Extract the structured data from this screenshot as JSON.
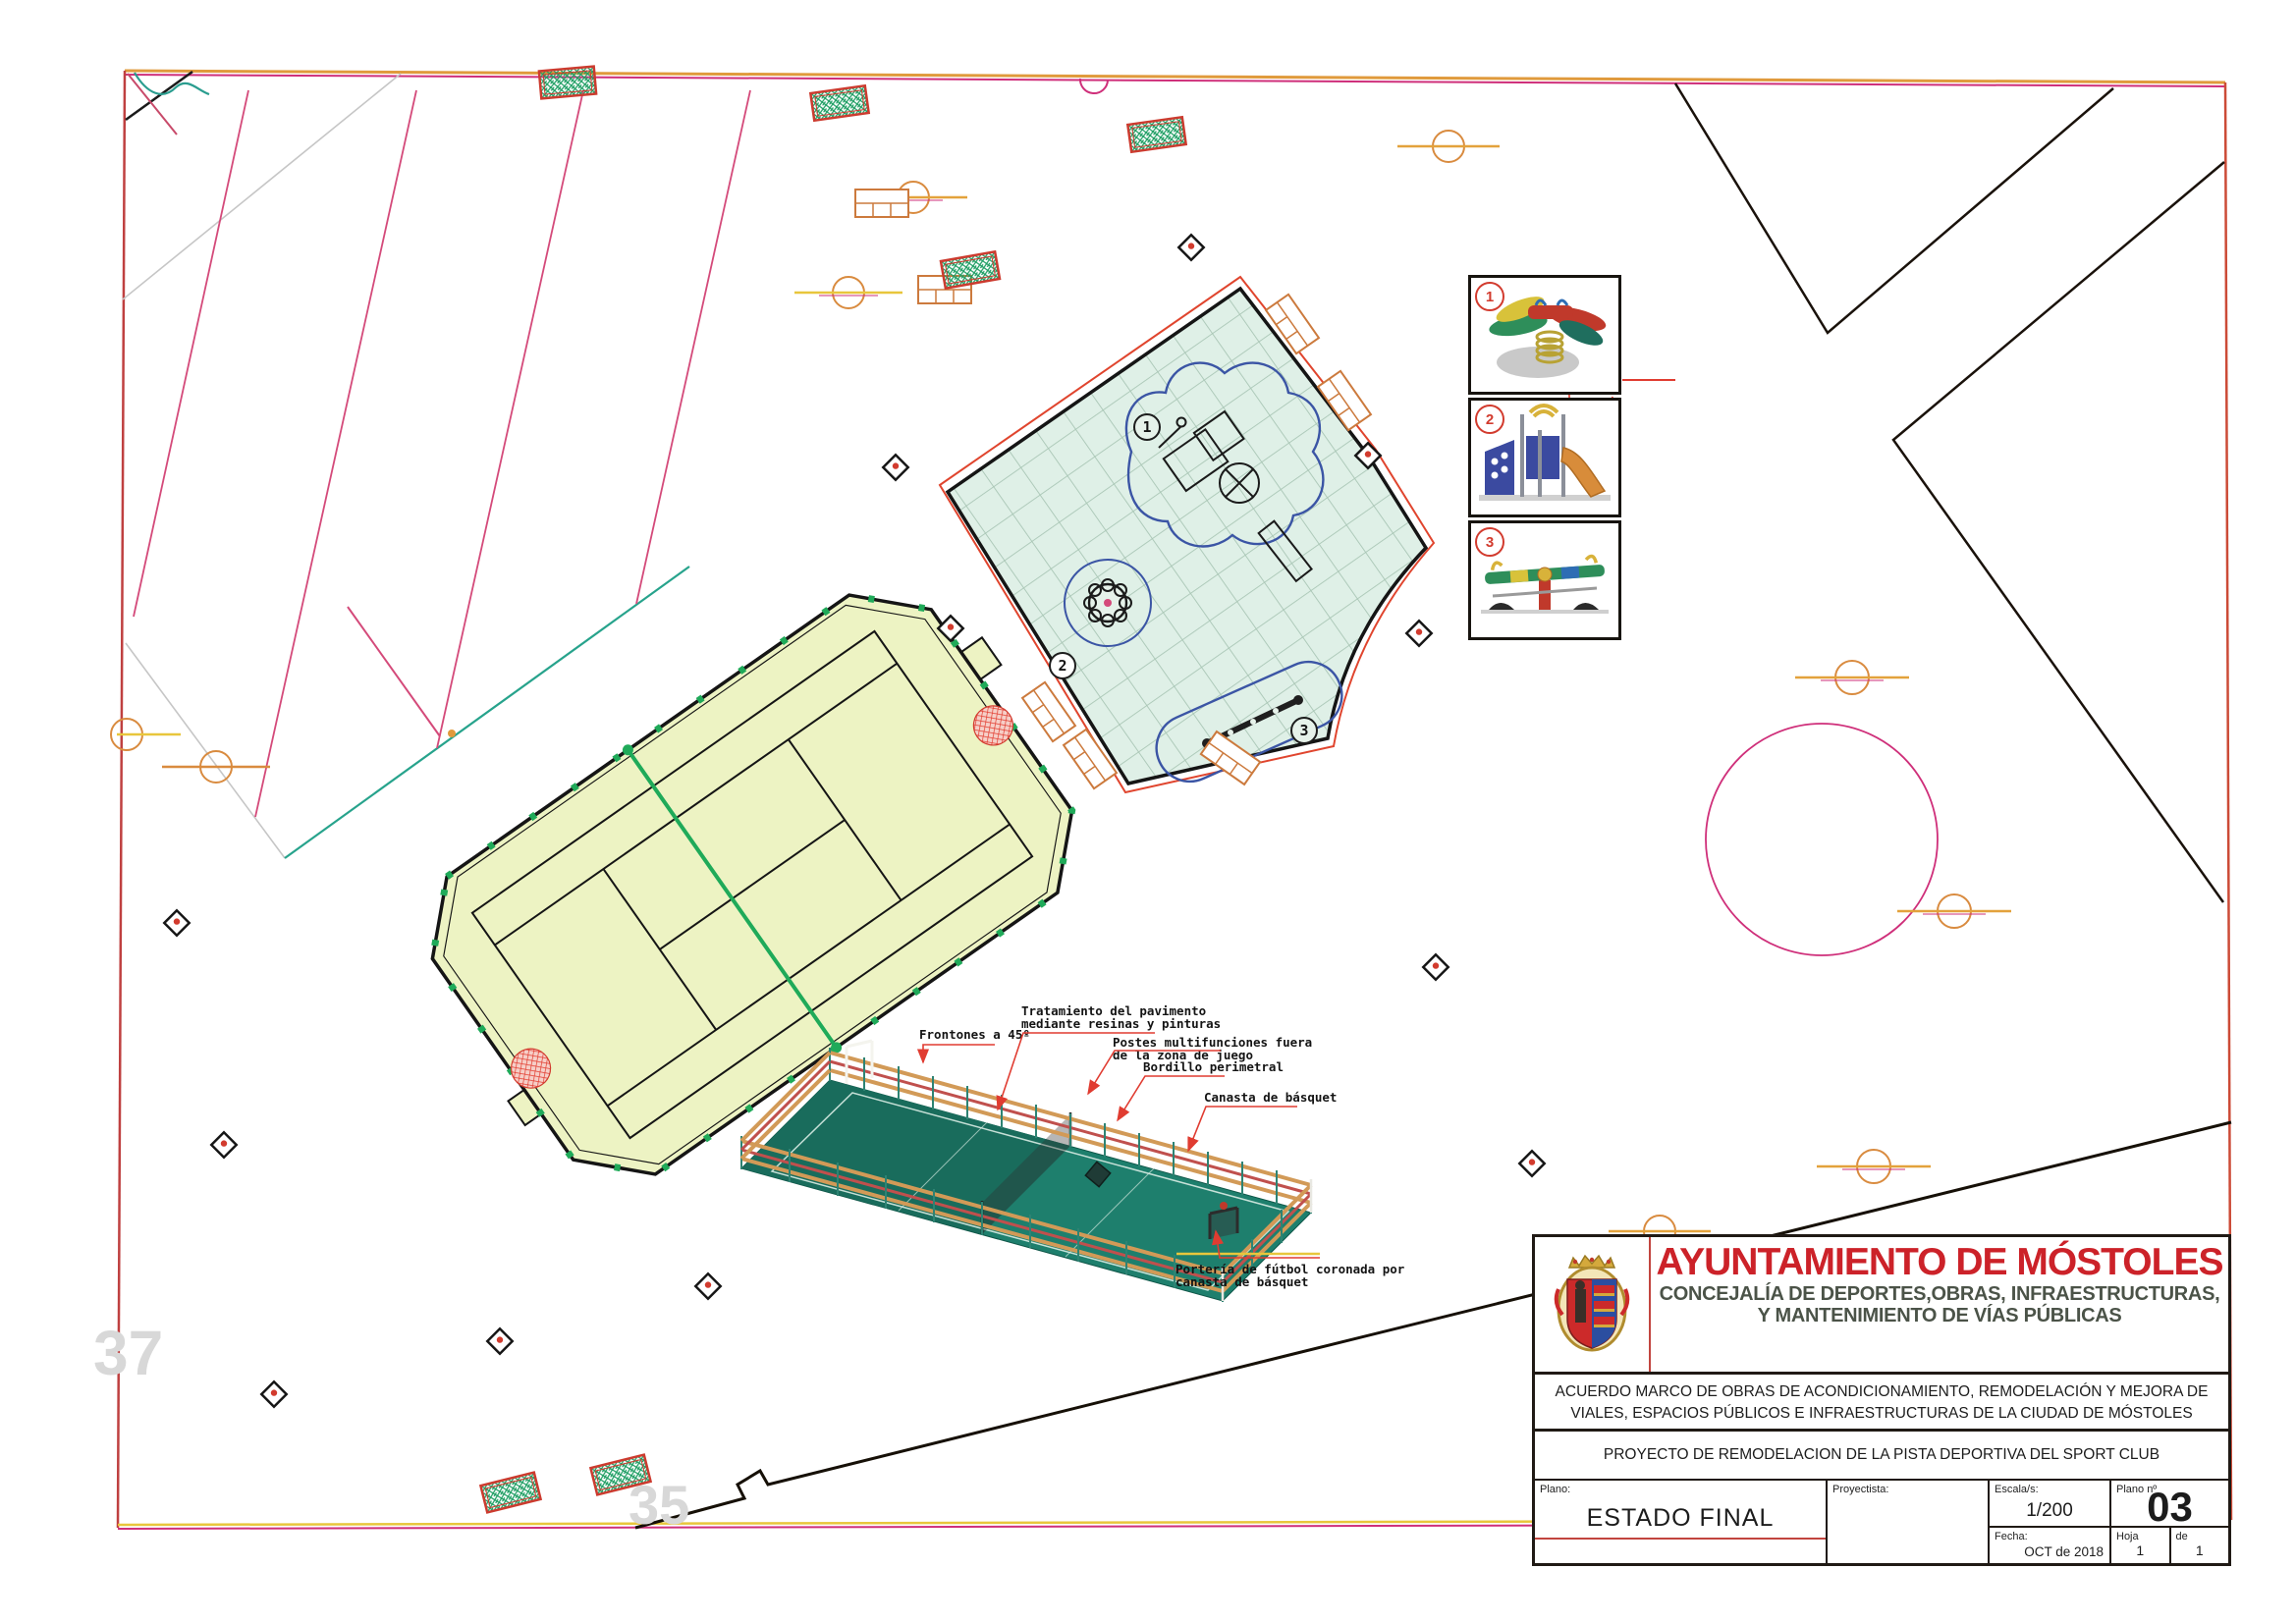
{
  "sheet": {
    "parcel_numbers": {
      "left": "37",
      "right": "35"
    },
    "equipment_items": [
      {
        "number": "1",
        "name": "spring-rider"
      },
      {
        "number": "2",
        "name": "play-structure-with-slide"
      },
      {
        "number": "3",
        "name": "multi-seesaw"
      }
    ],
    "callouts": {
      "frontones": "Frontones a 45º",
      "tratamiento_1": "Tratamiento del pavimento",
      "tratamiento_2": "mediante resinas  y pinturas",
      "postes_1": "Postes multifunciones fuera",
      "postes_2": "de la zona de  juego",
      "bordillo": "Bordillo perimetral",
      "canasta": "Canasta de básquet",
      "porteria_1": "Portería de fútbol coronada por",
      "porteria_2": "canasta de básquet"
    }
  },
  "title_block": {
    "organization": "AYUNTAMIENTO DE MÓSTOLES",
    "department_line1": "CONCEJALÍA DE  DEPORTES,OBRAS, INFRAESTRUCTURAS,",
    "department_line2": "Y MANTENIMIENTO DE VÍAS PÚBLICAS",
    "agreement_line1": "ACUERDO MARCO DE OBRAS DE ACONDICIONAMIENTO, REMODELACIÓN Y MEJORA DE",
    "agreement_line2": "VIALES, ESPACIOS PÚBLICOS E INFRAESTRUCTURAS DE LA CIUDAD DE MÓSTOLES",
    "project_title": "PROYECTO DE REMODELACION DE LA PISTA DEPORTIVA  DEL SPORT CLUB",
    "plano_label": "Plano:",
    "plano_value": "ESTADO FINAL",
    "proyectista_label": "Proyectista:",
    "escala_label": "Escala/s:",
    "escala_value": "1/200",
    "plano_num_label": "Plano nº",
    "plano_num_value": "03",
    "fecha_label": "Fecha:",
    "fecha_value": "OCT  de 2018",
    "hoja_label": "Hoja",
    "hoja_value": "1",
    "de_label": "de",
    "de_value": "1"
  },
  "colors": {
    "title_red": "#cc2229",
    "department_gray": "#4b5348",
    "leader_red": "#e03c31",
    "frame_orange": "#e09a3c",
    "frame_magenta": "#cf2f7a",
    "court_fill": "#edf3c3",
    "playground_fill": "#dff0e7",
    "sport_court_green": "#1e7f6d",
    "stripe_pink": "#d44a7a"
  }
}
